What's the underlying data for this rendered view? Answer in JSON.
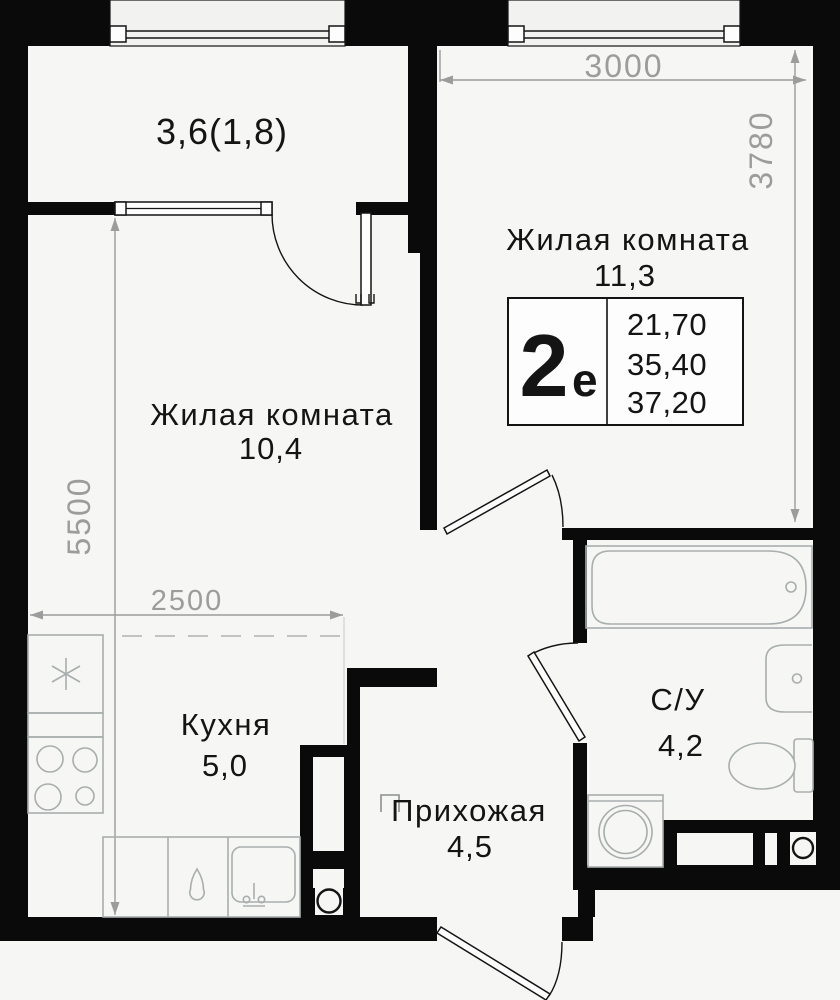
{
  "plan": {
    "balcony": {
      "label": "3,6(1,8)"
    },
    "rooms": {
      "living1": {
        "name": "Жилая комната",
        "area": "11,3"
      },
      "living2": {
        "name": "Жилая комната",
        "area": "10,4"
      },
      "kitchen": {
        "name": "Кухня",
        "area": "5,0"
      },
      "hall": {
        "name": "Прихожая",
        "area": "4,5"
      },
      "bath": {
        "name": "С/У",
        "area": "4,2"
      }
    },
    "stamp": {
      "type_digit": "2",
      "type_letter": "е",
      "line1": "21,70",
      "line2": "35,40",
      "line3": "37,20"
    },
    "dims": {
      "top": "3000",
      "right": "3780",
      "left": "5500",
      "kitchen": "2500"
    },
    "colors": {
      "wall": "#0a0a0a",
      "dimension": "#9c9c9c",
      "fixture": "#a8aeae",
      "text": "#141414",
      "background": "#f6f6f4"
    }
  }
}
